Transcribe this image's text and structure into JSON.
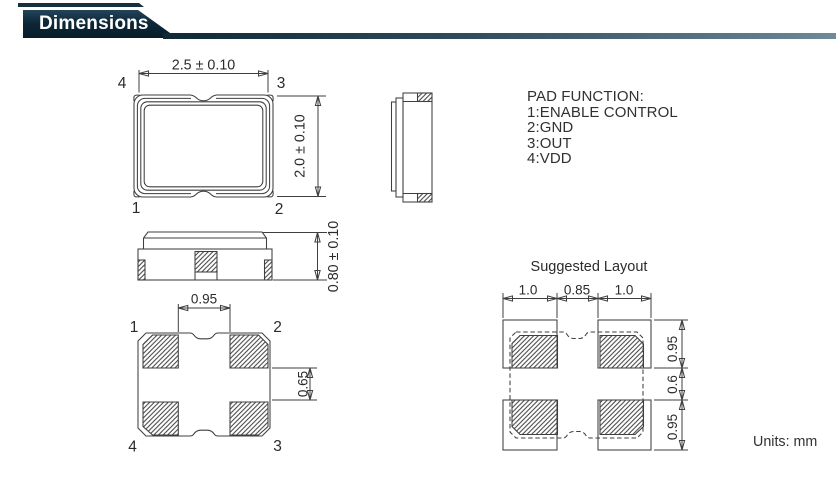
{
  "header": {
    "title": "Dimensions"
  },
  "top_view": {
    "width_dim": "2.5 ± 0.10",
    "height_dim": "2.0 ± 0.10",
    "pin_top_left": "4",
    "pin_top_right": "3",
    "pin_bottom_left": "1",
    "pin_bottom_right": "2"
  },
  "front_view": {
    "height_dim": "0.80 ± 0.10"
  },
  "pad_function": {
    "title": "PAD FUNCTION:",
    "items": [
      "1:ENABLE CONTROL",
      "2:GND",
      "3:OUT",
      "4:VDD"
    ]
  },
  "bottom_view": {
    "pad_gap_dim": "0.95",
    "pad_offset_dim": "0.65",
    "pin_top_left": "1",
    "pin_top_right": "2",
    "pin_bottom_left": "4",
    "pin_bottom_right": "3"
  },
  "suggested_layout": {
    "title": "Suggested Layout",
    "horizontal_dims": [
      "1.0",
      "0.85",
      "1.0"
    ],
    "vertical_dims": [
      "0.95",
      "0.6",
      "0.95"
    ]
  },
  "units_note": "Units: mm",
  "colors": {
    "header_tab": "#0d2838",
    "header_rule_start": "#0f2936",
    "header_rule_end": "#5f7d8d",
    "line": "#3f3f3f",
    "text": "#2b2b2b"
  }
}
